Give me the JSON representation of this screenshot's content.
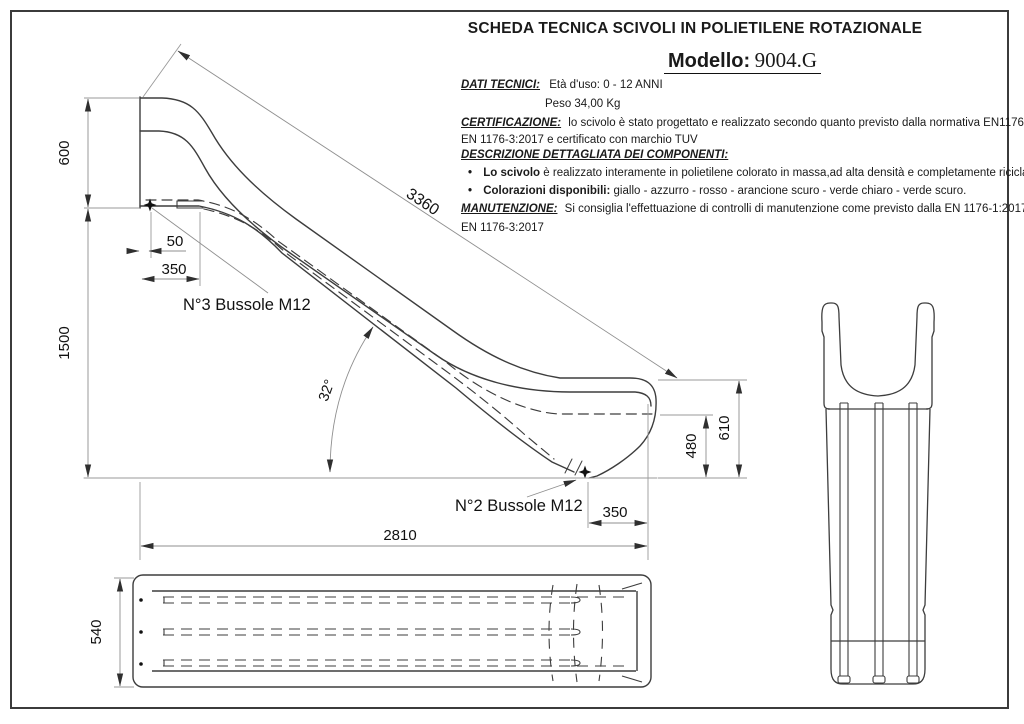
{
  "header": {
    "title": "SCHEDA TECNICA SCIVOLI  IN POLIETILENE ROTAZIONALE",
    "model_label": "Modello:",
    "model_value": "9004.G"
  },
  "specs": {
    "dati_label": "DATI TECNICI:",
    "eta": "Età d'uso: 0 - 12 ANNI",
    "peso": "Peso 34,00 Kg",
    "cert_label": "CERTIFICAZIONE:",
    "cert_line1": "lo scivolo è stato progettato e realizzato secondo quanto previsto dalla normativa EN1176-1:2017",
    "cert_line2": "EN 1176-3:2017 e certificato con marchio TUV",
    "descr_label": "DESCRIZIONE DETTAGLIATA DEI COMPONENTI:",
    "bullet_glyph": "•",
    "bullet1_bold": "Lo scivolo",
    "bullet1_text": " è realizzato interamente in polietilene  colorato in massa,ad alta densità e completamente riciclabile.",
    "bullet2_bold": "Colorazioni disponibili:",
    "bullet2_text": " giallo - azzurro - rosso - arancione scuro - verde chiaro - verde scuro.",
    "manut_label": "MANUTENZIONE:",
    "manut_line1": "Si consiglia l'effettuazione di controlli di manutenzione come previsto dalla EN 1176-1:2017",
    "manut_line2": "EN 1176-3:2017"
  },
  "dimensions": {
    "platform_height": "600",
    "ground_height": "1500",
    "bussola_offset": "50",
    "platform_depth": "350",
    "slide_length": "3360",
    "slide_angle": "32°",
    "exit_height_inner": "480",
    "exit_height_outer": "610",
    "exit_depth": "350",
    "total_length": "2810",
    "slide_width": "540",
    "bussole_top_label": "N°3 Bussole M12",
    "bussole_bottom_label": "N°2 Bussole M12"
  },
  "colors": {
    "line": "#3d3d3d",
    "dim_line": "#8f8f8f",
    "frame": "#3b3b3b"
  }
}
